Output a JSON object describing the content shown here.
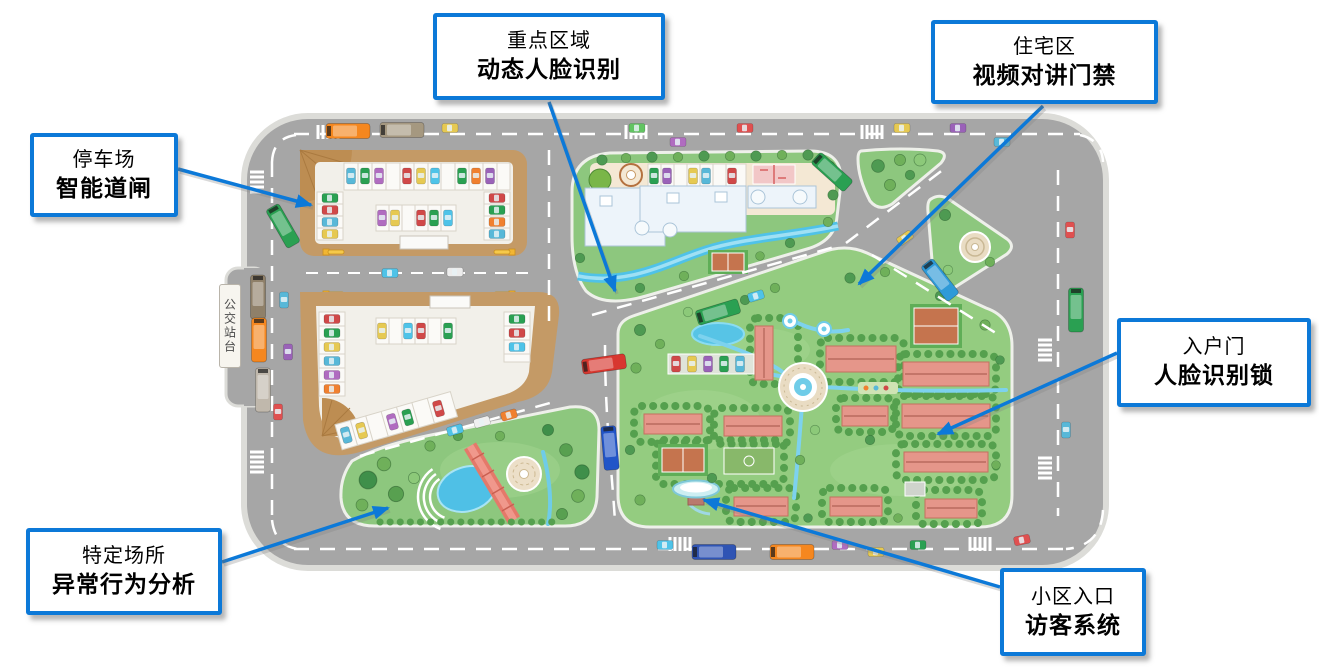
{
  "colors": {
    "callout_border": "#0c79d8",
    "arrow": "#0c79d8",
    "road": "#a6a6a6",
    "grass": "#8dc77e",
    "parking_tan": "#c49a66",
    "water": "#4fc0e6",
    "roof_pink": "#e5968a"
  },
  "map": {
    "bus_stop_label": "公交站台"
  },
  "callouts": {
    "key_area": {
      "line1": "重点区域",
      "line2": "动态人脸识别"
    },
    "residential": {
      "line1": "住宅区",
      "line2": "视频对讲门禁"
    },
    "parking": {
      "line1": "停车场",
      "line2": "智能道闸"
    },
    "entry_door": {
      "line1": "入户门",
      "line2": "人脸识别锁"
    },
    "special_place": {
      "line1": "特定场所",
      "line2": "异常行为分析"
    },
    "entrance": {
      "line1": "小区入口",
      "line2": "访客系统"
    }
  }
}
